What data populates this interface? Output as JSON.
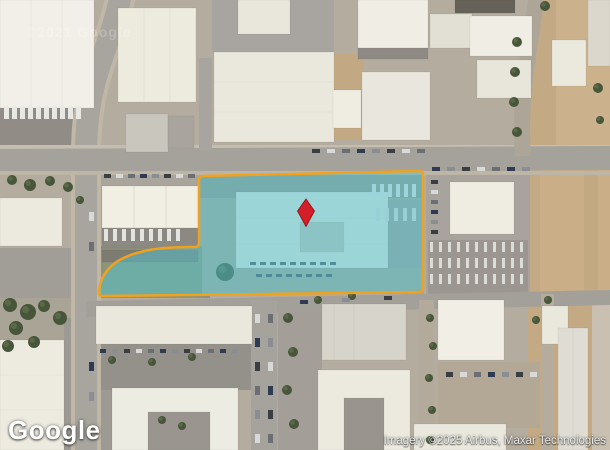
{
  "map": {
    "logo": "Google",
    "attribution": "Imagery ©2025 Airbus, Maxar Technologies",
    "watermark": "©2021 Google"
  },
  "overlay": {
    "parcel_fill": "rgba(80,195,212,0.5)",
    "parcel_stroke": "#f0a21f",
    "parcel_stroke_width": "2.5",
    "pin_color": "#d41e28",
    "pin_outline": "#8e0f14",
    "pin_x": 306,
    "pin_y": 212
  }
}
